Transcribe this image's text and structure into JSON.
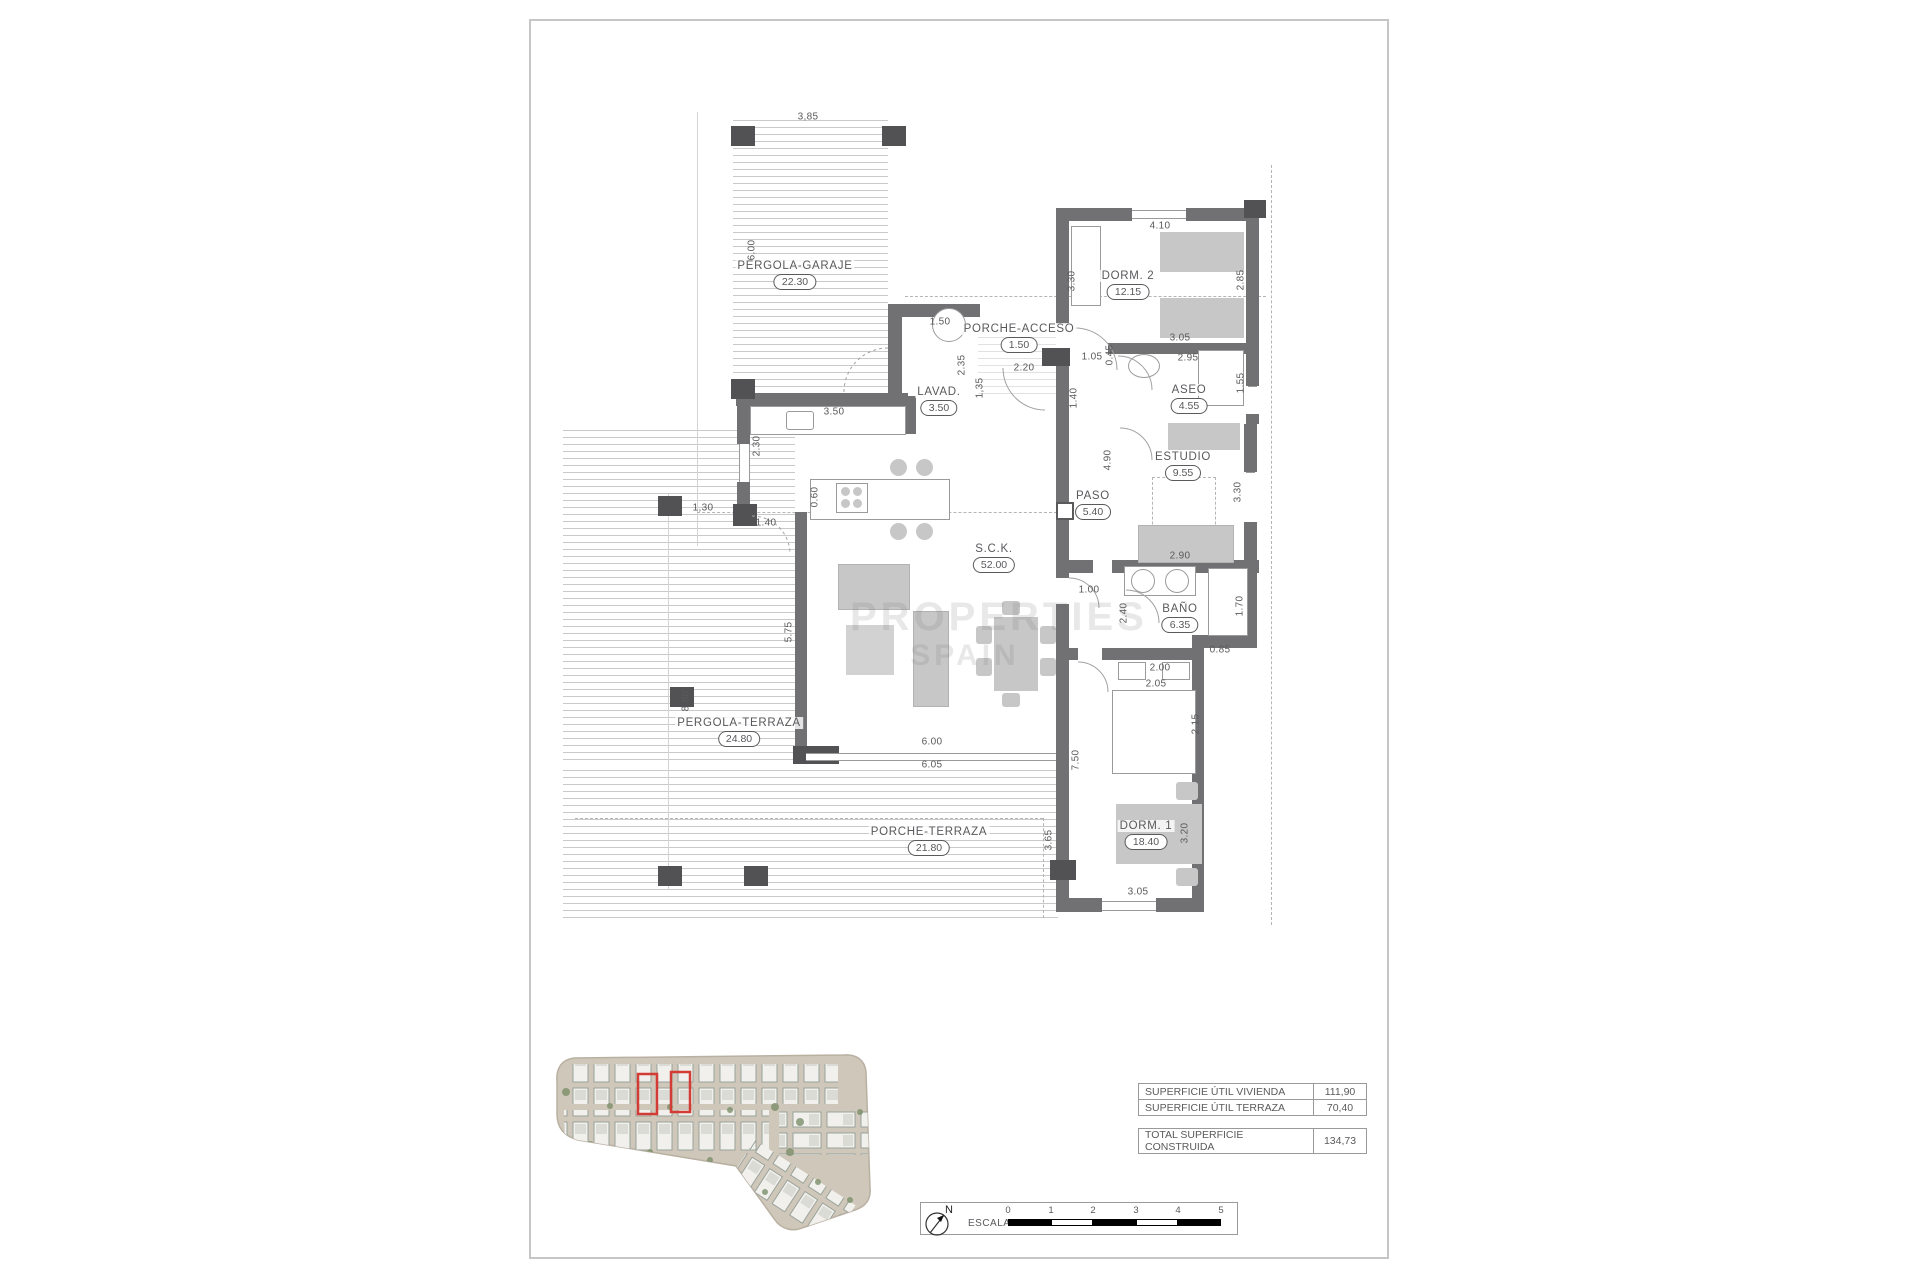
{
  "plan": {
    "rooms": [
      {
        "name": "PERGOLA-GARAJE",
        "area": "22.30"
      },
      {
        "name": "PORCHE-ACCESO",
        "area": "1.50"
      },
      {
        "name": "LAVAD.",
        "area": "3.50"
      },
      {
        "name": "DORM. 2",
        "area": "12.15"
      },
      {
        "name": "ASEO",
        "area": "4.55"
      },
      {
        "name": "ESTUDIO",
        "area": "9.55"
      },
      {
        "name": "PASO",
        "area": "5.40"
      },
      {
        "name": "S.C.K.",
        "area": "52.00"
      },
      {
        "name": "BAÑO",
        "area": "6.35"
      },
      {
        "name": "DORM. 1",
        "area": "18.40"
      },
      {
        "name": "PERGOLA-TERRAZA",
        "area": "24.80"
      },
      {
        "name": "PORCHE-TERRAZA",
        "area": "21.80"
      }
    ],
    "dims": [
      "3,85",
      "6.00",
      "1.50",
      "2.35",
      "1,35",
      "2.20",
      "1.05",
      "0.45",
      "1.40",
      "3.30",
      "4.10",
      "2.85",
      "3.05",
      "2.95",
      "1.55",
      "4.90",
      "3.30",
      "2.90",
      "1.70",
      "0.85",
      "2.40",
      "1.00",
      "2.00",
      "2.05",
      "2.15",
      "7.50",
      "3.20",
      "3.05",
      "3.65",
      "1,30",
      "1.40",
      "2.30",
      "3.50",
      "0.60",
      "5.75",
      "8.80",
      "6.00",
      "6.05"
    ]
  },
  "summary": {
    "rows": [
      {
        "label": "SUPERFICIE ÚTIL VIVIENDA",
        "value": "111,90"
      },
      {
        "label": "SUPERFICIE ÚTIL TERRAZA",
        "value": "70,40"
      }
    ],
    "total": {
      "label": "TOTAL SUPERFICIE CONSTRUIDA",
      "value": "134,73"
    }
  },
  "scalebar": {
    "label": "ESCALA :",
    "ticks": [
      "0",
      "1",
      "2",
      "3",
      "4",
      "5"
    ]
  },
  "north_label": "N",
  "watermark": {
    "line1": "PROPERTIES",
    "line2": "SPAIN"
  },
  "colors": {
    "wall": "#717174",
    "accent_red": "#d23c34",
    "land_tan": "#cfc7b9"
  }
}
